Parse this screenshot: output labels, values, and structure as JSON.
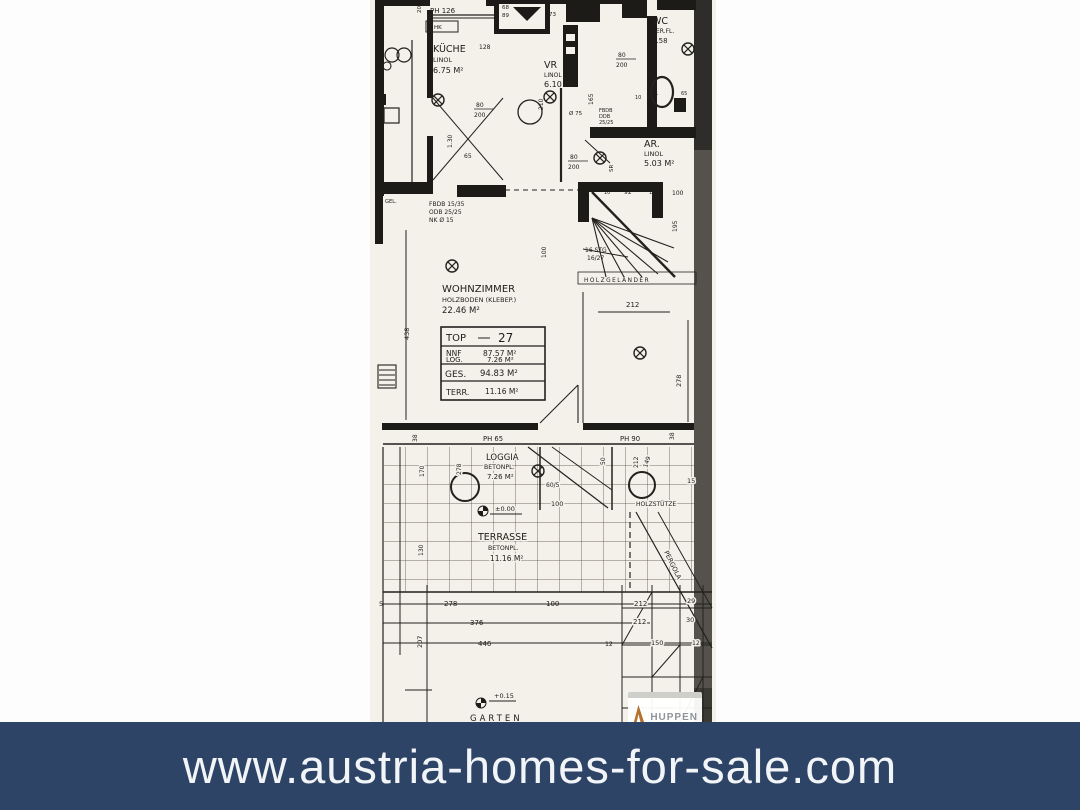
{
  "banner": {
    "url": "www.austria-homes-for-sale.com",
    "bg": "#2e4466",
    "fg": "#f2f5f8"
  },
  "watermark": {
    "text": "HUPPEN",
    "accent": "#b5722f",
    "text_color": "#8f959c"
  },
  "plan": {
    "paper_color": "#f3f1ea",
    "ink_color": "#1d1b18",
    "rooms": {
      "kueche": {
        "name": "KÜCHE",
        "floor": "LINOL",
        "area": "6.75 M²"
      },
      "vr": {
        "name": "VR",
        "floor": "LINOL",
        "area": "6.10 M²"
      },
      "wc": {
        "name": "WC",
        "floor": "KER.FL.",
        "area": "1.58"
      },
      "ar": {
        "name": "AR.",
        "floor": "LINOL",
        "area": "5.03 M²"
      },
      "wohnzimmer": {
        "name": "WOHNZIMMER",
        "floor": "HOLZBODEN (KLEBEP.)",
        "area": "22.46 M²"
      },
      "loggia": {
        "name": "LOGGIA",
        "floor": "BETONPL.",
        "area": "7.26 M²"
      },
      "terrasse": {
        "name": "TERRASSE",
        "floor": "BETONPL.",
        "area": "11.16 M²"
      },
      "garten": {
        "name": "GARTEN"
      }
    },
    "info_box": {
      "top_label": "TOP",
      "top_value": "27",
      "nnf_label": "NNF",
      "nnf": "87.57 M²",
      "log_label": "LOG.",
      "log": "7.26 M²",
      "ges_label": "GES.",
      "ges": "94.83 M²",
      "terr_label": "TERR.",
      "terr": "11.16 M²"
    },
    "stairs": {
      "steps": "16 STG",
      "ratio": "16/27",
      "railing": "HOLZGELÄNDER"
    },
    "site": {
      "holzstuetze": "HOLZSTÜTZE",
      "pergola": "PERGOLA",
      "level_zero": "±0.00",
      "level_garden": "+0.15"
    },
    "notes": {
      "hk": "HK",
      "gel": "GEL.",
      "fbdb": "FBDB 15/35",
      "odb": "ODB 25/25",
      "nk": "NK Ø 15",
      "fbdb2": "FBDB",
      "ddb": "DDB",
      "d2525": "25/25",
      "sr": "SR",
      "dia75": "Ø 75"
    },
    "dims": {
      "ph126": "PH 126",
      "ph65": "PH 65",
      "ph90": "PH 90",
      "d5": "5",
      "d10": "10",
      "d12": "12",
      "d15": "15",
      "d20": "20",
      "d29": "29",
      "d30": "30",
      "d31": "31",
      "d38": "38",
      "d50": "50",
      "d55": "55",
      "d60_5": "60/5",
      "d65": "65",
      "d68": "68",
      "d73": "73",
      "d80": "80",
      "d89": "89",
      "d92": "92",
      "d100": "100",
      "d128": "128",
      "d130_m": "1.30",
      "d130": "130",
      "d149": "149",
      "d150": "150",
      "d165": "165",
      "d170": "170",
      "d195": "195",
      "d200": "200",
      "d207": "207",
      "d210": "210",
      "d212": "212",
      "d278": "278",
      "d376": "376",
      "d438": "438",
      "d446": "446"
    }
  }
}
